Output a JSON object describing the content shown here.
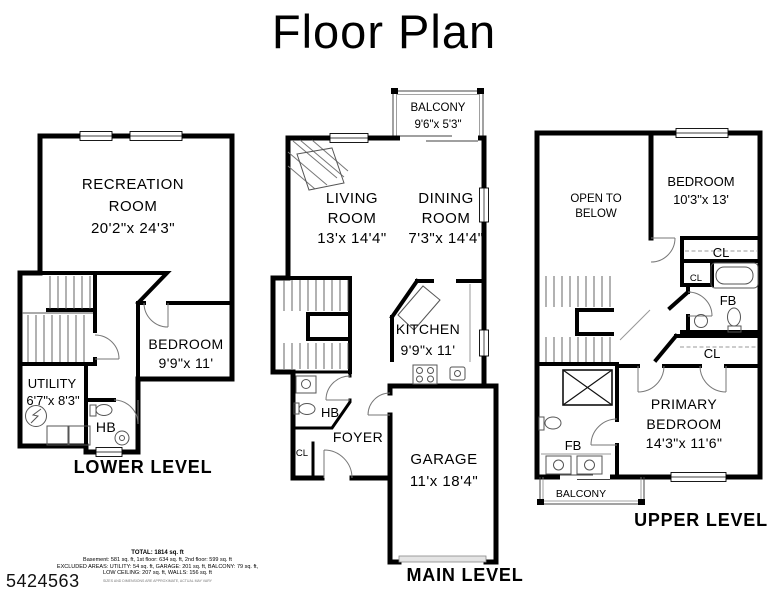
{
  "title": "Floor Plan",
  "mls_number": "5424563",
  "colors": {
    "wall": "#000000",
    "background": "#ffffff",
    "thin_line": "#555555"
  },
  "levels": {
    "lower": {
      "label": "LOWER LEVEL",
      "rooms": {
        "recreation": {
          "name1": "RECREATION",
          "name2": "ROOM",
          "dims": "20'2\"x 24'3\""
        },
        "bedroom": {
          "name": "BEDROOM",
          "dims": "9'9\"x 11'"
        },
        "utility": {
          "name": "UTILITY",
          "dims": "6'7\"x 8'3\""
        },
        "hb": {
          "name": "HB"
        }
      }
    },
    "main": {
      "label": "MAIN LEVEL",
      "rooms": {
        "balcony": {
          "name": "BALCONY",
          "dims": "9'6\"x 5'3\""
        },
        "living": {
          "name1": "LIVING",
          "name2": "ROOM",
          "dims": "13'x 14'4\""
        },
        "dining": {
          "name1": "DINING",
          "name2": "ROOM",
          "dims": "7'3\"x 14'4\""
        },
        "kitchen": {
          "name": "KITCHEN",
          "dims": "9'9\"x 11'"
        },
        "hb": {
          "name": "HB"
        },
        "foyer": {
          "name": "FOYER"
        },
        "closet": {
          "name": "CL"
        },
        "garage": {
          "name": "GARAGE",
          "dims": "11'x 18'4\""
        }
      }
    },
    "upper": {
      "label": "UPPER LEVEL",
      "rooms": {
        "open_to_below": {
          "name1": "OPEN TO",
          "name2": "BELOW"
        },
        "bedroom": {
          "name": "BEDROOM",
          "dims": "10'3\"x 13'"
        },
        "closet_top": {
          "name": "CL"
        },
        "closet_small": {
          "name": "CL"
        },
        "full_bath_top": {
          "name": "FB"
        },
        "closet_mid": {
          "name": "CL"
        },
        "primary": {
          "name1": "PRIMARY",
          "name2": "BEDROOM",
          "dims": "14'3\"x 11'6\""
        },
        "full_bath_bottom": {
          "name": "FB"
        },
        "balcony": {
          "name": "BALCONY"
        }
      }
    }
  },
  "summary": {
    "total": "TOTAL: 1814 sq. ft",
    "line1": "Basement: 581 sq. ft, 1st floor: 634 sq. ft, 2nd floor: 599 sq. ft",
    "line2": "EXCLUDED AREAS: UTILITY: 54 sq. ft, GARAGE: 201 sq. ft, BALCONY: 79 sq. ft,",
    "line3": "LOW CEILING: 207 sq. ft, WALLS: 156 sq. ft",
    "disclaimer": "SIZES AND DIMENSIONS ARE APPROXIMATE, ACTUAL MAY VARY"
  }
}
